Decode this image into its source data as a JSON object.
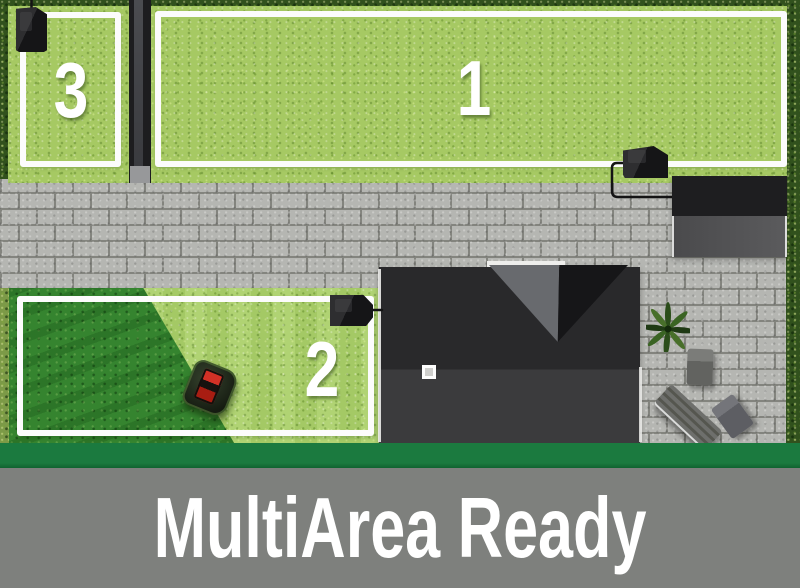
{
  "banner": {
    "title": "MultiArea Ready"
  },
  "zones": [
    {
      "label": "1"
    },
    {
      "label": "2"
    },
    {
      "label": "3"
    }
  ],
  "objects": {
    "mower": "robotic-mower",
    "charging_stations": [
      "charging-station-zone-3",
      "charging-station-zone-1",
      "charging-station-zone-2"
    ],
    "house": "house-roof",
    "garage": "garage-roof",
    "plant": "patio-plant",
    "furniture": [
      "patio-chair",
      "lounge-chair",
      "patio-chair"
    ]
  },
  "colors": {
    "grass_light": "#a6c963",
    "grass_mowed": "#abd06a",
    "grass_unmowed": "#35842f",
    "hedge_dark": "#31511d",
    "paver_gray": "#b5b6b2",
    "accent_green": "#1b7a3f",
    "banner_gray": "#7e807d",
    "mower_red": "#d23126",
    "text_white": "#ffffff"
  }
}
